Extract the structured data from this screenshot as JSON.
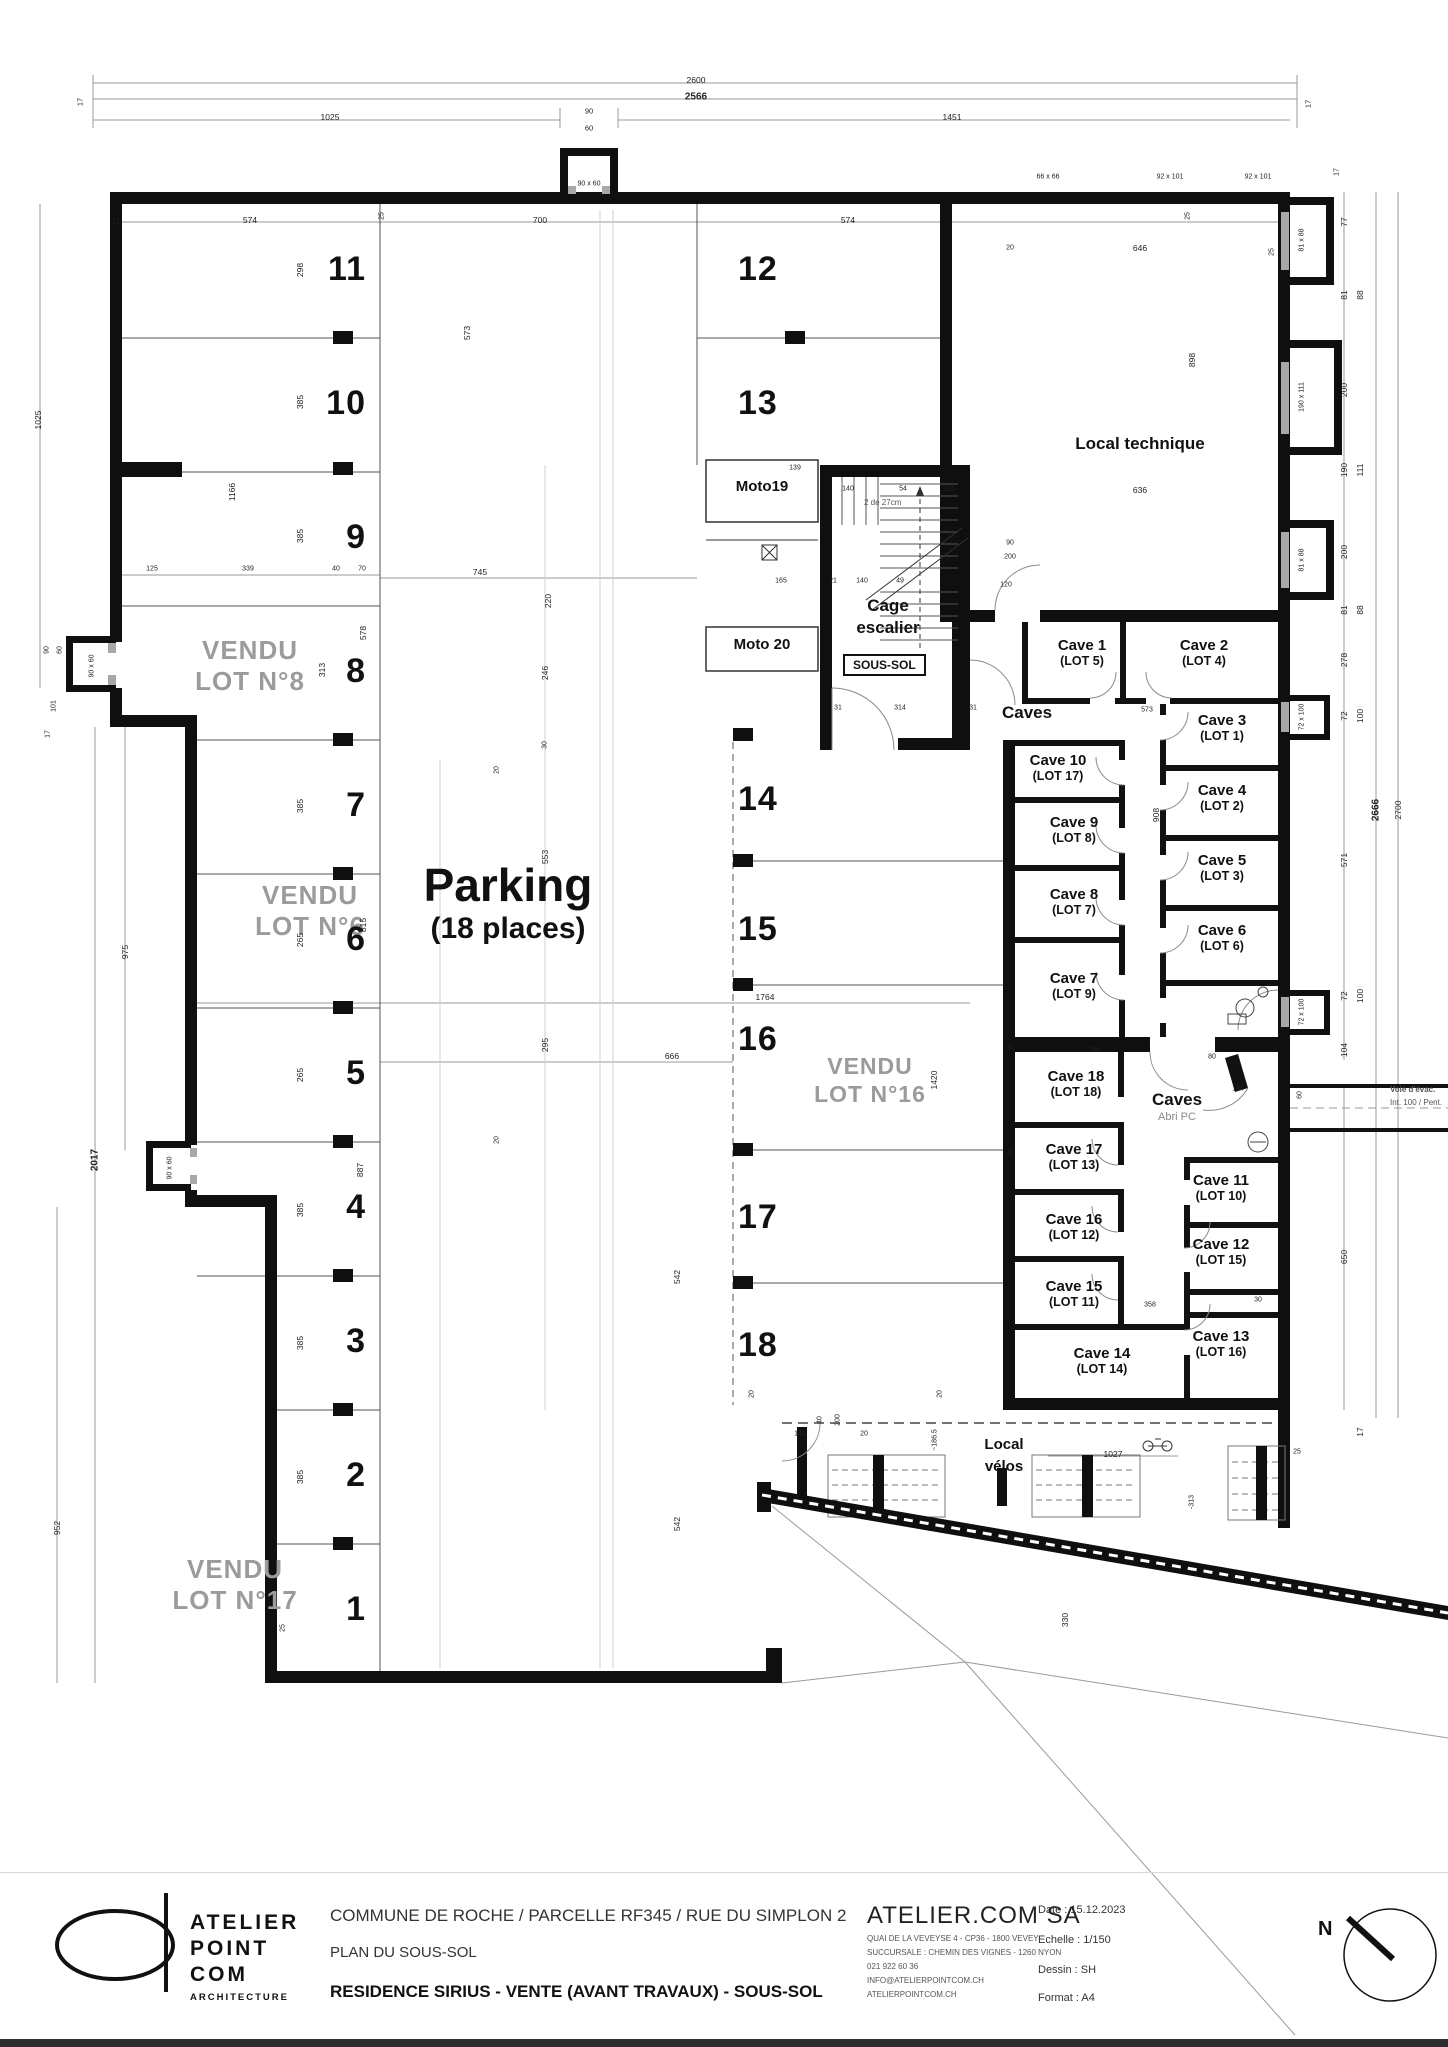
{
  "plan": {
    "labels": {
      "parking_title": "Parking",
      "parking_sub": "(18 places)",
      "local_technique": "Local technique",
      "cage_l1": "Cage",
      "cage_l2": "escalier",
      "sous_sol": "SOUS-SOL",
      "caves_upper": "Caves",
      "caves_lower": "Caves",
      "abri": "Abri PC",
      "velos_l1": "Local",
      "velos_l2": "vélos",
      "evac_l1": "Voie d'évac.",
      "evac_l2": "Int. 100 / Pent.",
      "moto19": "Moto19",
      "moto20": "Moto 20",
      "stair_note": "2 de 27cm"
    },
    "vendu": [
      {
        "l1": "VENDU",
        "l2": "LOT N°8"
      },
      {
        "l1": "VENDU",
        "l2": "LOT N°6"
      },
      {
        "l1": "VENDU",
        "l2": "LOT N°17"
      },
      {
        "l1": "VENDU",
        "l2": "LOT N°16"
      }
    ],
    "spots": [
      "1",
      "2",
      "3",
      "4",
      "5",
      "6",
      "7",
      "8",
      "9",
      "10",
      "11",
      "12",
      "13",
      "14",
      "15",
      "16",
      "17",
      "18"
    ],
    "caves": [
      {
        "n": "Cave 1",
        "lot": "(LOT 5)"
      },
      {
        "n": "Cave 2",
        "lot": "(LOT 4)"
      },
      {
        "n": "Cave 3",
        "lot": "(LOT 1)"
      },
      {
        "n": "Cave 4",
        "lot": "(LOT 2)"
      },
      {
        "n": "Cave 5",
        "lot": "(LOT 3)"
      },
      {
        "n": "Cave 6",
        "lot": "(LOT 6)"
      },
      {
        "n": "Cave 7",
        "lot": "(LOT 9)"
      },
      {
        "n": "Cave 8",
        "lot": "(LOT 7)"
      },
      {
        "n": "Cave 9",
        "lot": "(LOT 8)"
      },
      {
        "n": "Cave 10",
        "lot": "(LOT 17)"
      },
      {
        "n": "Cave 11",
        "lot": "(LOT 10)"
      },
      {
        "n": "Cave 12",
        "lot": "(LOT 15)"
      },
      {
        "n": "Cave 13",
        "lot": "(LOT 16)"
      },
      {
        "n": "Cave 14",
        "lot": "(LOT 14)"
      },
      {
        "n": "Cave 15",
        "lot": "(LOT 11)"
      },
      {
        "n": "Cave 16",
        "lot": "(LOT 12)"
      },
      {
        "n": "Cave 17",
        "lot": "(LOT 13)"
      },
      {
        "n": "Cave 18",
        "lot": "(LOT 18)"
      }
    ],
    "dims": [
      {
        "t": "2600",
        "x": 696,
        "y": 80
      },
      {
        "t": "2566",
        "x": 696,
        "y": 97,
        "b": 1
      },
      {
        "t": "1025",
        "x": 330,
        "y": 117
      },
      {
        "t": "90",
        "x": 589,
        "y": 111,
        "s": 7.5
      },
      {
        "t": "60",
        "x": 589,
        "y": 128,
        "s": 7.5
      },
      {
        "t": "1451",
        "x": 952,
        "y": 117
      },
      {
        "t": "17",
        "x": 80,
        "y": 102,
        "r": 1,
        "s": 7.5
      },
      {
        "t": "17",
        "x": 1308,
        "y": 104,
        "r": 1,
        "s": 7.5
      },
      {
        "t": "90 x 60",
        "x": 589,
        "y": 184,
        "s": 7
      },
      {
        "t": "66 x 66",
        "x": 1048,
        "y": 177,
        "s": 7
      },
      {
        "t": "92 x 101",
        "x": 1170,
        "y": 177,
        "s": 7
      },
      {
        "t": "92 x 101",
        "x": 1258,
        "y": 177,
        "s": 7
      },
      {
        "t": "17",
        "x": 1337,
        "y": 172,
        "r": 1,
        "s": 7
      },
      {
        "t": "17",
        "x": 116,
        "y": 222,
        "s": 7
      },
      {
        "t": "574",
        "x": 250,
        "y": 220
      },
      {
        "t": "25",
        "x": 382,
        "y": 216,
        "r": 1,
        "s": 7
      },
      {
        "t": "700",
        "x": 540,
        "y": 220
      },
      {
        "t": "574",
        "x": 848,
        "y": 220
      },
      {
        "t": "25",
        "x": 1188,
        "y": 216,
        "r": 1,
        "s": 7
      },
      {
        "t": "20",
        "x": 1010,
        "y": 248,
        "s": 7
      },
      {
        "t": "646",
        "x": 1140,
        "y": 248
      },
      {
        "t": "25",
        "x": 1272,
        "y": 252,
        "r": 1,
        "s": 7
      },
      {
        "t": "298",
        "x": 300,
        "y": 270,
        "r": 1
      },
      {
        "t": "573",
        "x": 467,
        "y": 333,
        "r": 1
      },
      {
        "t": "385",
        "x": 300,
        "y": 402,
        "r": 1
      },
      {
        "t": "1166",
        "x": 232,
        "y": 492,
        "r": 1
      },
      {
        "t": "385",
        "x": 300,
        "y": 536,
        "r": 1
      },
      {
        "t": "313",
        "x": 322,
        "y": 670,
        "r": 1
      },
      {
        "t": "385",
        "x": 300,
        "y": 806,
        "r": 1
      },
      {
        "t": "265",
        "x": 300,
        "y": 940,
        "r": 1
      },
      {
        "t": "265",
        "x": 300,
        "y": 1075,
        "r": 1
      },
      {
        "t": "385",
        "x": 300,
        "y": 1210,
        "r": 1
      },
      {
        "t": "385",
        "x": 300,
        "y": 1343,
        "r": 1
      },
      {
        "t": "385",
        "x": 300,
        "y": 1477,
        "r": 1
      },
      {
        "t": "887",
        "x": 360,
        "y": 1170,
        "r": 1
      },
      {
        "t": "578",
        "x": 363,
        "y": 633,
        "r": 1
      },
      {
        "t": "815",
        "x": 363,
        "y": 925,
        "r": 1
      },
      {
        "t": "952",
        "x": 57,
        "y": 1528,
        "r": 1
      },
      {
        "t": "975",
        "x": 125,
        "y": 952,
        "r": 1
      },
      {
        "t": "2017",
        "x": 95,
        "y": 1160,
        "r": 1,
        "b": 1
      },
      {
        "t": "90 x 60",
        "x": 170,
        "y": 1168,
        "r": 1,
        "s": 7
      },
      {
        "t": "1025",
        "x": 38,
        "y": 420,
        "r": 1
      },
      {
        "t": "90",
        "x": 47,
        "y": 650,
        "r": 1,
        "s": 7
      },
      {
        "t": "60",
        "x": 60,
        "y": 650,
        "r": 1,
        "s": 7
      },
      {
        "t": "101",
        "x": 54,
        "y": 706,
        "r": 1,
        "s": 7
      },
      {
        "t": "17",
        "x": 48,
        "y": 734,
        "r": 1,
        "s": 7
      },
      {
        "t": "90 x 60",
        "x": 92,
        "y": 666,
        "r": 1,
        "s": 7
      },
      {
        "t": "125",
        "x": 152,
        "y": 569,
        "s": 7
      },
      {
        "t": "339",
        "x": 248,
        "y": 569,
        "s": 7
      },
      {
        "t": "40",
        "x": 336,
        "y": 569,
        "s": 7
      },
      {
        "t": "70",
        "x": 362,
        "y": 569,
        "s": 7
      },
      {
        "t": "25",
        "x": 283,
        "y": 1628,
        "r": 1,
        "s": 7
      },
      {
        "t": "745",
        "x": 480,
        "y": 572
      },
      {
        "t": "220",
        "x": 548,
        "y": 601,
        "r": 1
      },
      {
        "t": "246",
        "x": 545,
        "y": 673,
        "r": 1
      },
      {
        "t": "30",
        "x": 545,
        "y": 745,
        "r": 1,
        "s": 7
      },
      {
        "t": "553",
        "x": 545,
        "y": 857,
        "r": 1
      },
      {
        "t": "295",
        "x": 545,
        "y": 1045,
        "r": 1
      },
      {
        "t": "542",
        "x": 677,
        "y": 1277,
        "r": 1
      },
      {
        "t": "542",
        "x": 677,
        "y": 1524,
        "r": 1
      },
      {
        "t": "666",
        "x": 672,
        "y": 1056
      },
      {
        "t": "1764",
        "x": 765,
        "y": 997
      },
      {
        "t": "20",
        "x": 497,
        "y": 770,
        "r": 1,
        "s": 7
      },
      {
        "t": "20",
        "x": 497,
        "y": 1140,
        "r": 1,
        "s": 7
      },
      {
        "t": "1420",
        "x": 934,
        "y": 1080,
        "r": 1
      },
      {
        "t": "20",
        "x": 752,
        "y": 1394,
        "r": 1,
        "s": 7
      },
      {
        "t": "20",
        "x": 940,
        "y": 1394,
        "r": 1,
        "s": 7
      },
      {
        "t": "139",
        "x": 795,
        "y": 468,
        "s": 7
      },
      {
        "t": "140",
        "x": 848,
        "y": 489,
        "s": 7
      },
      {
        "t": "54",
        "x": 903,
        "y": 489,
        "s": 7
      },
      {
        "t": "120",
        "x": 948,
        "y": 489,
        "s": 7
      },
      {
        "t": "165",
        "x": 781,
        "y": 581,
        "s": 7
      },
      {
        "t": "21",
        "x": 833,
        "y": 581,
        "s": 7
      },
      {
        "t": "140",
        "x": 862,
        "y": 581,
        "s": 7
      },
      {
        "t": "49",
        "x": 900,
        "y": 581,
        "s": 7
      },
      {
        "t": "31",
        "x": 838,
        "y": 708,
        "s": 7
      },
      {
        "t": "314",
        "x": 900,
        "y": 708,
        "s": 7
      },
      {
        "t": "31",
        "x": 973,
        "y": 708,
        "s": 7
      },
      {
        "t": "90",
        "x": 1010,
        "y": 543,
        "s": 7
      },
      {
        "t": "200",
        "x": 1010,
        "y": 557,
        "s": 7
      },
      {
        "t": "120",
        "x": 1006,
        "y": 585,
        "s": 7
      },
      {
        "t": "573",
        "x": 1147,
        "y": 710,
        "s": 7
      },
      {
        "t": "636",
        "x": 1140,
        "y": 490
      },
      {
        "t": "898",
        "x": 1192,
        "y": 360,
        "r": 1
      },
      {
        "t": "908",
        "x": 1156,
        "y": 815,
        "r": 1
      },
      {
        "t": "358",
        "x": 1150,
        "y": 1305,
        "s": 7
      },
      {
        "t": "294",
        "x": 1095,
        "y": 1050,
        "s": 7
      },
      {
        "t": "30",
        "x": 1010,
        "y": 1048,
        "s": 7
      },
      {
        "t": "80",
        "x": 1212,
        "y": 1057,
        "s": 7
      },
      {
        "t": "184",
        "x": 1238,
        "y": 1089,
        "s": 7
      },
      {
        "t": "30",
        "x": 1012,
        "y": 1152,
        "r": 1,
        "s": 7
      },
      {
        "t": "30",
        "x": 1258,
        "y": 1300,
        "s": 7
      },
      {
        "t": "77",
        "x": 1344,
        "y": 222,
        "r": 1
      },
      {
        "t": "81",
        "x": 1344,
        "y": 295,
        "r": 1
      },
      {
        "t": "88",
        "x": 1360,
        "y": 295,
        "r": 1
      },
      {
        "t": "200",
        "x": 1344,
        "y": 390,
        "r": 1
      },
      {
        "t": "190",
        "x": 1344,
        "y": 470,
        "r": 1
      },
      {
        "t": "111",
        "x": 1360,
        "y": 470,
        "r": 1
      },
      {
        "t": "200",
        "x": 1344,
        "y": 552,
        "r": 1
      },
      {
        "t": "81",
        "x": 1344,
        "y": 610,
        "r": 1
      },
      {
        "t": "88",
        "x": 1360,
        "y": 610,
        "r": 1
      },
      {
        "t": "278",
        "x": 1344,
        "y": 660,
        "r": 1
      },
      {
        "t": "72",
        "x": 1344,
        "y": 716,
        "r": 1
      },
      {
        "t": "100",
        "x": 1360,
        "y": 716,
        "r": 1
      },
      {
        "t": "571",
        "x": 1344,
        "y": 860,
        "r": 1
      },
      {
        "t": "72",
        "x": 1344,
        "y": 996,
        "r": 1
      },
      {
        "t": "100",
        "x": 1360,
        "y": 996,
        "r": 1
      },
      {
        "t": "104",
        "x": 1344,
        "y": 1050,
        "r": 1
      },
      {
        "t": "2666",
        "x": 1376,
        "y": 810,
        "r": 1,
        "b": 1
      },
      {
        "t": "2700",
        "x": 1398,
        "y": 810,
        "r": 1
      },
      {
        "t": "650",
        "x": 1344,
        "y": 1257,
        "r": 1
      },
      {
        "t": "17",
        "x": 1360,
        "y": 1432,
        "r": 1
      },
      {
        "t": "81 x 88",
        "x": 1302,
        "y": 240,
        "r": 1,
        "s": 7
      },
      {
        "t": "190 x 111",
        "x": 1302,
        "y": 397,
        "r": 1,
        "s": 7
      },
      {
        "t": "81 x 88",
        "x": 1302,
        "y": 560,
        "r": 1,
        "s": 7
      },
      {
        "t": "72 x 100",
        "x": 1302,
        "y": 717,
        "r": 1,
        "s": 7
      },
      {
        "t": "72 x 100",
        "x": 1302,
        "y": 1012,
        "r": 1,
        "s": 7
      },
      {
        "t": "60",
        "x": 1300,
        "y": 1095,
        "r": 1,
        "s": 7
      },
      {
        "t": "144",
        "x": 800,
        "y": 1434,
        "s": 7
      },
      {
        "t": "40",
        "x": 820,
        "y": 1420,
        "r": 1,
        "s": 7
      },
      {
        "t": "200",
        "x": 838,
        "y": 1420,
        "r": 1,
        "s": 7
      },
      {
        "t": "20",
        "x": 864,
        "y": 1434,
        "s": 7
      },
      {
        "t": "~186.5",
        "x": 935,
        "y": 1440,
        "r": 1,
        "s": 7
      },
      {
        "t": "1027",
        "x": 1113,
        "y": 1454
      },
      {
        "t": "25",
        "x": 1297,
        "y": 1452,
        "s": 7
      },
      {
        "t": "-313",
        "x": 1192,
        "y": 1502,
        "r": 1,
        "s": 7
      },
      {
        "t": "330",
        "x": 1065,
        "y": 1620,
        "r": 1
      }
    ]
  },
  "title_block": {
    "logo": {
      "l1": "ATELIER",
      "l2": "POINT",
      "l3": "COM",
      "sub": "ARCHITECTURE"
    },
    "project_line": "COMMUNE DE ROCHE / PARCELLE RF345 / RUE DU SIMPLON 2",
    "plan_line": "PLAN DU SOUS-SOL",
    "title_line": "RESIDENCE SIRIUS - VENTE (AVANT TRAVAUX) - SOUS-SOL",
    "firm": {
      "name": "ATELIER.COM SA",
      "address1": "QUAI DE LA VEVEYSE 4 - CP36 - 1800 VEVEY",
      "address2": "SUCCURSALE : CHEMIN DES VIGNES - 1260 NYON",
      "phone": "021 922 60 36",
      "email": "INFO@ATELIERPOINTCOM.CH",
      "web": "ATELIERPOINTCOM.CH"
    },
    "meta": {
      "date": "Date : 15.12.2023",
      "scale": "Echelle : 1/150",
      "drawn": "Dessin : SH",
      "format": "Format : A4"
    },
    "north_label": "N"
  }
}
